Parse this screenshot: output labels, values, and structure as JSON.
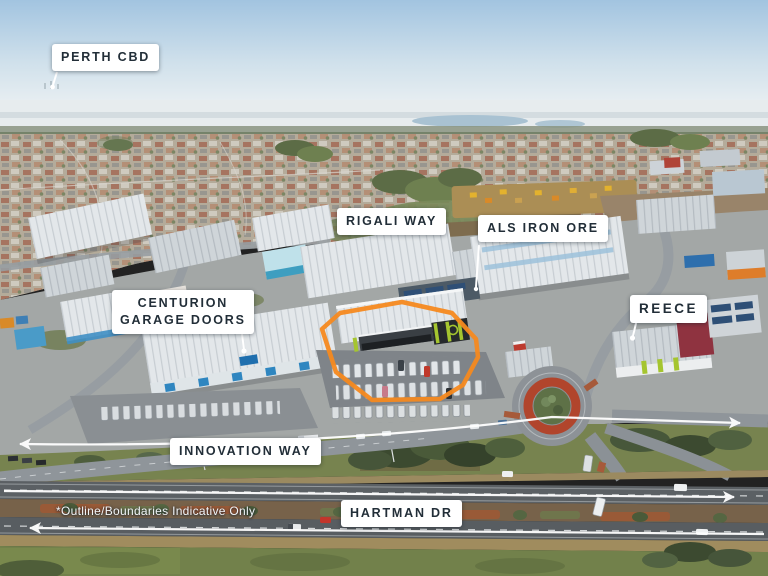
{
  "labels": {
    "perth_cbd": "PERTH CBD",
    "rigali_way": "RIGALI WAY",
    "als_iron_ore": "ALS IRON ORE",
    "centurion": {
      "line1": "CENTURION",
      "line2": "GARAGE DOORS"
    },
    "reece": "REECE",
    "innovation_way": "INNOVATION WAY",
    "hartman_dr": "HARTMAN DR"
  },
  "disclaimer": "*Outline/Boundaries Indicative Only",
  "colors": {
    "boundary_outline": "#F6891F",
    "label_background": "#FFFFFF",
    "label_text": "#222E38",
    "subject_accent_lime": "#A5C52F",
    "roundabout_ring_red": "#B1452C",
    "annotation_white": "#FFFFFF"
  },
  "annotations": {
    "boundary_icon": "subject-site-outline-icon",
    "road_arrow_icons": [
      "innovation-way-double-arrow-icon",
      "hartman-dr-east-arrow-icon",
      "hartman-dr-west-arrow-icon"
    ],
    "pointer_icons": [
      "perth-cbd-pointer-icon",
      "als-pointer-icon",
      "centurion-pointer-icon",
      "reece-pointer-icon"
    ]
  }
}
